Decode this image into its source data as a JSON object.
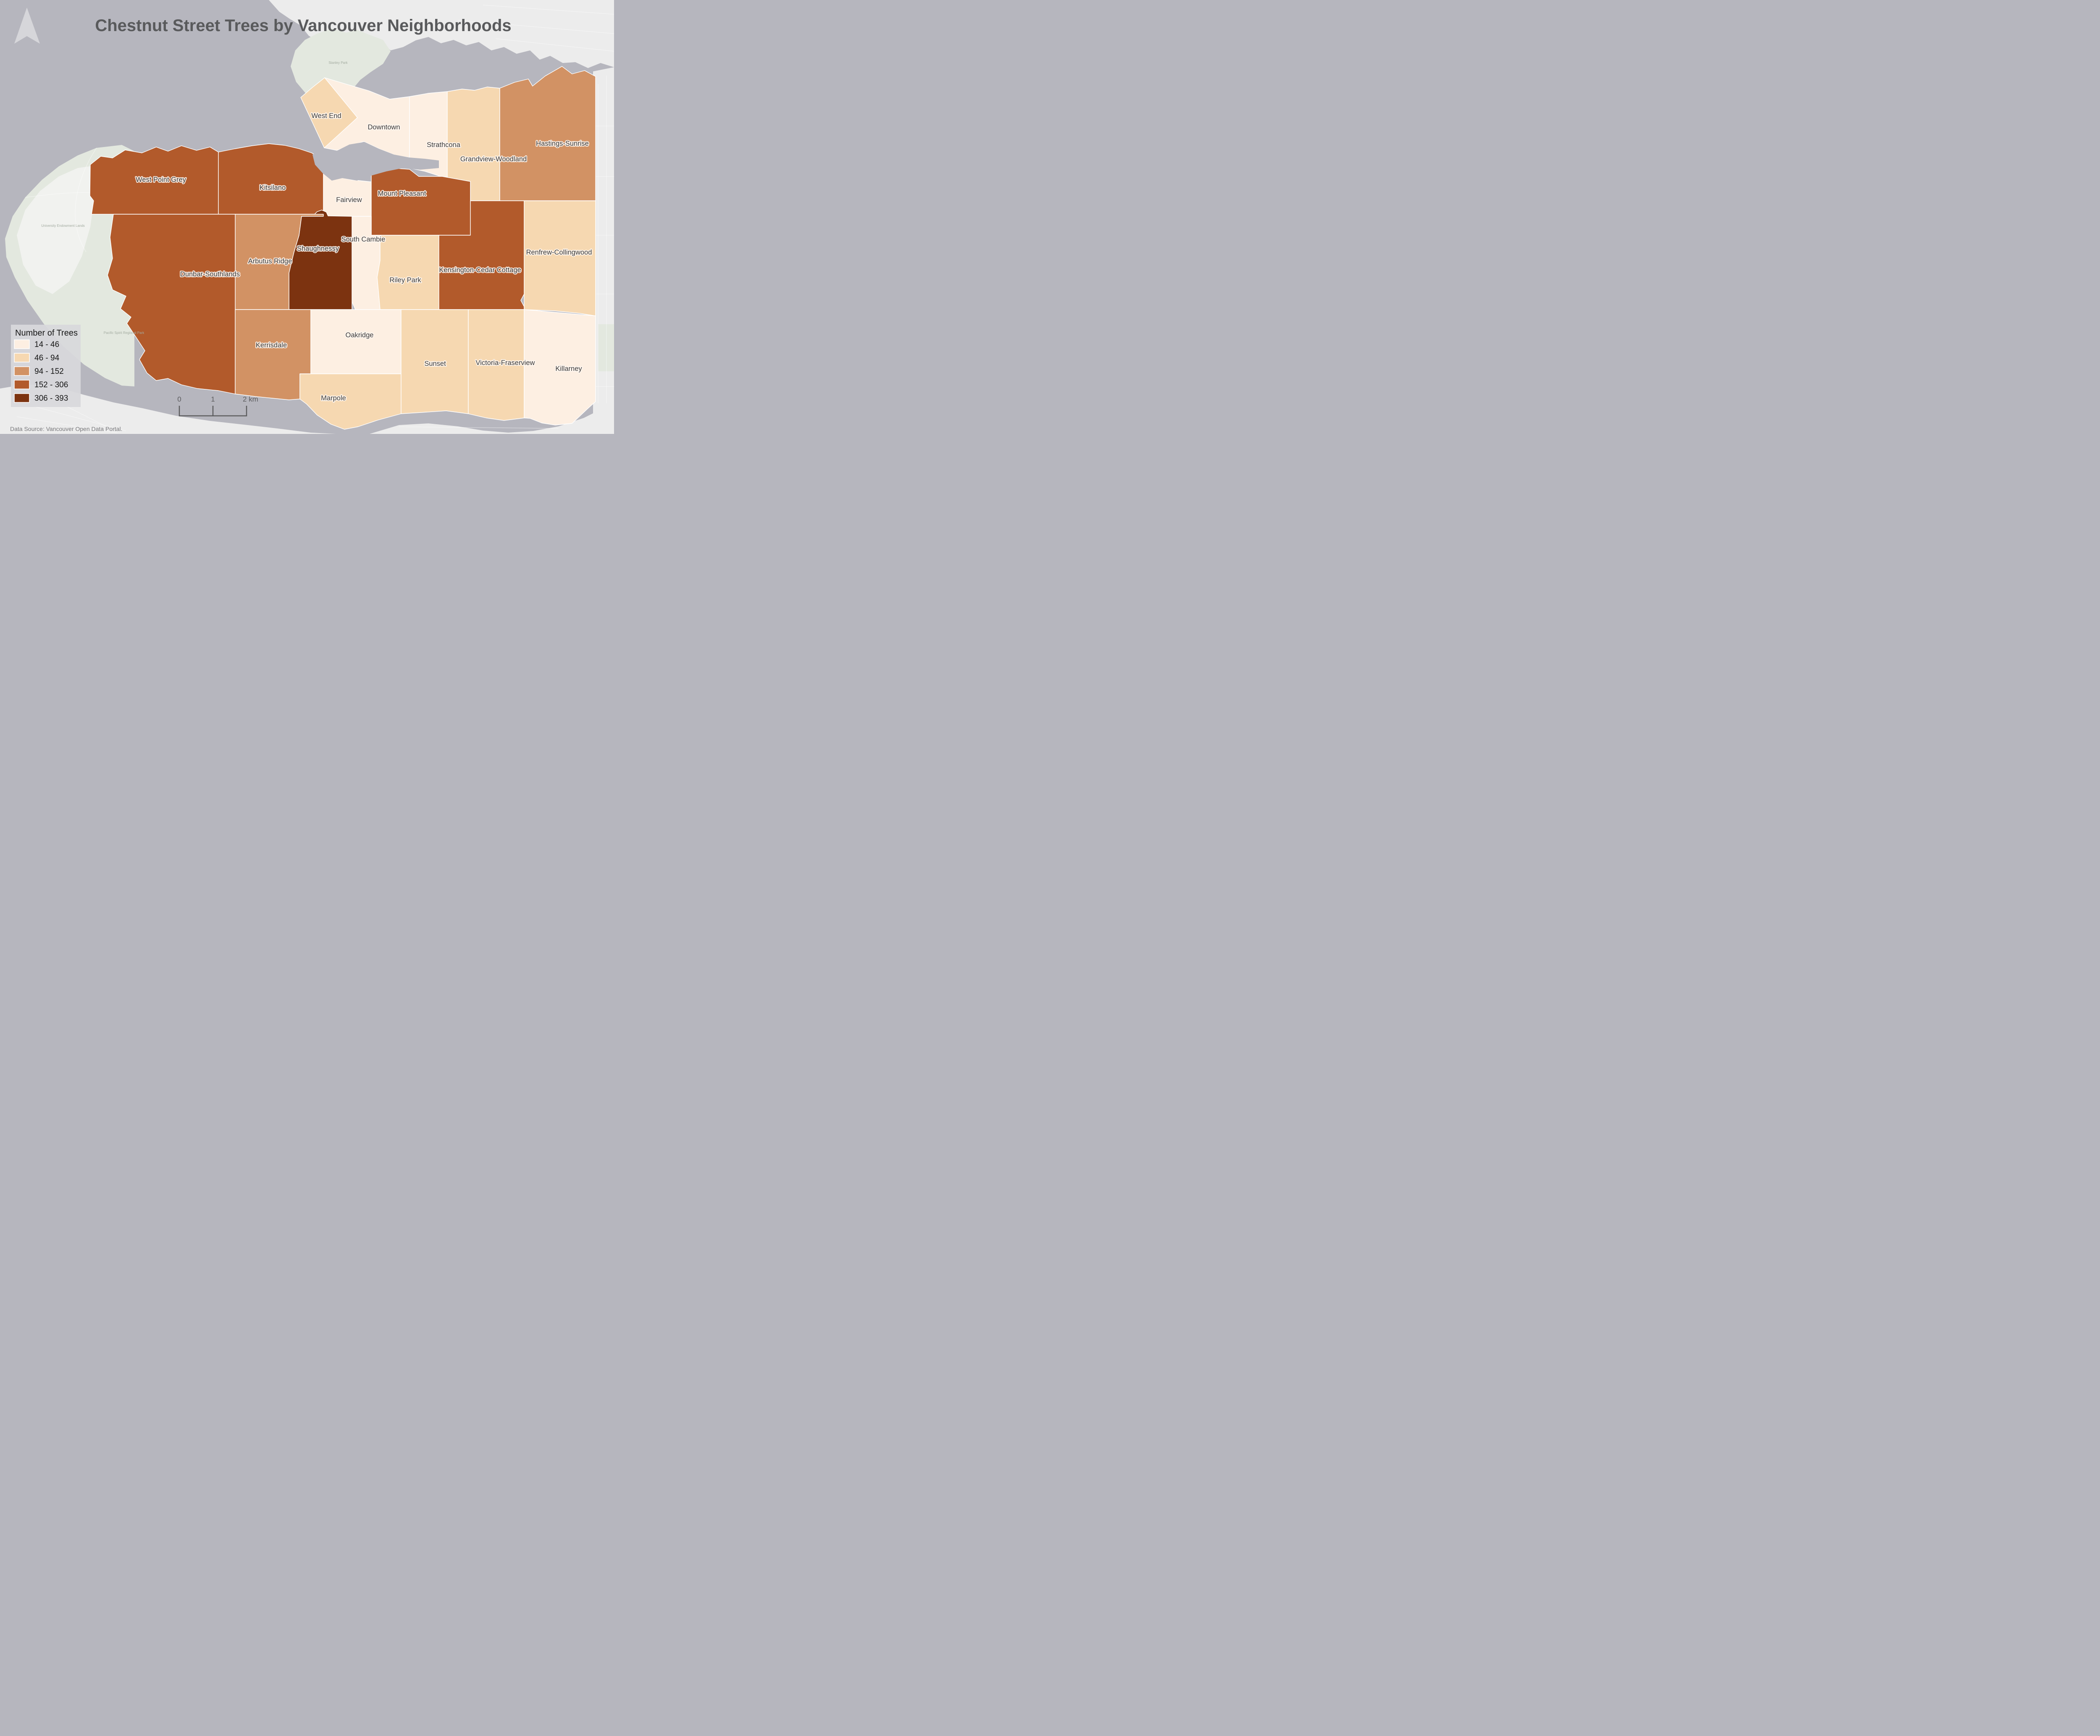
{
  "title": "Chestnut Street Trees by Vancouver Neighborhoods",
  "attribution": "Data Source: Vancouver Open Data Portal.",
  "palette": {
    "water": "#b6b6be",
    "land_basemap": "#ececec",
    "park_basemap": "#e3e8df",
    "campus_basemap": "#f1f2ef",
    "legend_bg": "#d8d8db",
    "north_arrow": "#d9d9dd",
    "label_text": "#3b3b3b",
    "title_text": "#595a5c"
  },
  "legend": {
    "title": "Number of Trees",
    "classes": [
      {
        "label": "14 - 46",
        "color": "#fdefe2"
      },
      {
        "label": "46 - 94",
        "color": "#f6d8b1"
      },
      {
        "label": "94 - 152",
        "color": "#d29264"
      },
      {
        "label": "152 - 306",
        "color": "#b25a2b"
      },
      {
        "label": "306 - 393",
        "color": "#7c3310"
      }
    ]
  },
  "scale_bar": {
    "tick0": "0",
    "tick1": "1",
    "tick2": "2 km"
  },
  "map_data": {
    "type": "choropleth",
    "value_field": "Number of Trees",
    "bins": [
      "14 - 46",
      "46 - 94",
      "94 - 152",
      "152 - 306",
      "306 - 393"
    ],
    "neighborhoods": [
      {
        "name": "West End",
        "bin": "46 - 94",
        "bin_index": 1
      },
      {
        "name": "Downtown",
        "bin": "14 - 46",
        "bin_index": 0
      },
      {
        "name": "Strathcona",
        "bin": "14 - 46",
        "bin_index": 0
      },
      {
        "name": "Grandview-Woodland",
        "bin": "46 - 94",
        "bin_index": 1
      },
      {
        "name": "Hastings-Sunrise",
        "bin": "94 - 152",
        "bin_index": 2
      },
      {
        "name": "West Point Grey",
        "bin": "152 - 306",
        "bin_index": 3
      },
      {
        "name": "Kitsilano",
        "bin": "152 - 306",
        "bin_index": 3
      },
      {
        "name": "Fairview",
        "bin": "14 - 46",
        "bin_index": 0
      },
      {
        "name": "Mount Pleasant",
        "bin": "152 - 306",
        "bin_index": 3
      },
      {
        "name": "South Cambie",
        "bin": "14 - 46",
        "bin_index": 0
      },
      {
        "name": "Shaughnessy",
        "bin": "306 - 393",
        "bin_index": 4
      },
      {
        "name": "Arbutus Ridge",
        "bin": "94 - 152",
        "bin_index": 2
      },
      {
        "name": "Dunbar-Southlands",
        "bin": "152 - 306",
        "bin_index": 3
      },
      {
        "name": "Riley Park",
        "bin": "46 - 94",
        "bin_index": 1
      },
      {
        "name": "Kensington-Cedar Cottage",
        "bin": "152 - 306",
        "bin_index": 3
      },
      {
        "name": "Renfrew-Collingwood",
        "bin": "46 - 94",
        "bin_index": 1
      },
      {
        "name": "Kerrisdale",
        "bin": "94 - 152",
        "bin_index": 2
      },
      {
        "name": "Oakridge",
        "bin": "14 - 46",
        "bin_index": 0
      },
      {
        "name": "Marpole",
        "bin": "46 - 94",
        "bin_index": 1
      },
      {
        "name": "Sunset",
        "bin": "46 - 94",
        "bin_index": 1
      },
      {
        "name": "Victoria-Fraserview",
        "bin": "46 - 94",
        "bin_index": 1
      },
      {
        "name": "Killarney",
        "bin": "14 - 46",
        "bin_index": 0
      }
    ]
  },
  "basemap": {
    "labels": [
      {
        "text": "Stanley Park"
      },
      {
        "text": "Pacific Spirit Regional Park"
      },
      {
        "text": "University Endowment Lands"
      }
    ]
  }
}
